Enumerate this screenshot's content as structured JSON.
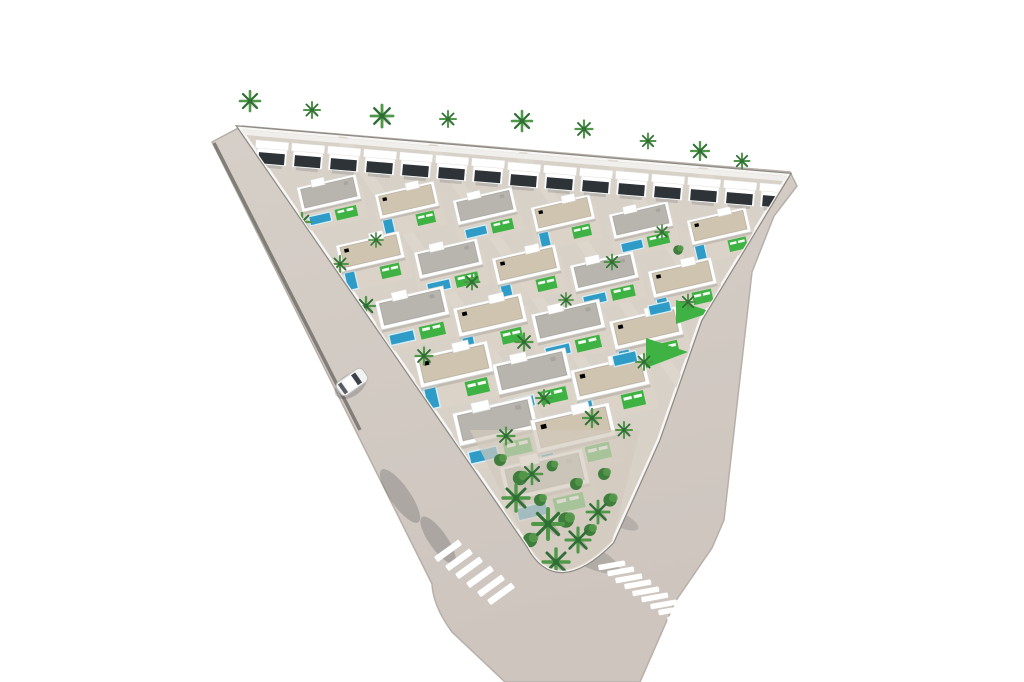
{
  "meta": {
    "title": "Aerial render of a triangular villa development",
    "description": "Bird's-eye 3D architectural rendering of a triangular residential plot filled with white flat-roof villas, each with a small blue swimming pool, bright green lawn and sun loungers. A back row of two-story houses with dark shaded facades lines the top edge. Palm trees are scattered through the plot and cluster at the landscaped bottom tip. Two light grey roads border the plot and meet at a rounded corner at the bottom with two white zebra crosswalks; a single white car drives on the left road. Background is pure white."
  },
  "palette": {
    "bg": "#ffffff",
    "road": "#cdc5be",
    "roadLight": "#d6cfc8",
    "curbDark": "#8e8a84",
    "ground": "#d8d1c8",
    "terrace": "#dcd3c8",
    "wallWhite": "#ffffff",
    "facadeDark": "#2e3338",
    "roofGravel": "#b8b5ae",
    "roofSand": "#cfc4af",
    "pool": "#2f9bc7",
    "lawn": "#3eb343",
    "palmGreen": "#4f9847",
    "palmDark": "#2f6e35",
    "stripe": "#ffffff",
    "street": "#ddd6cd",
    "carBody": "#f2f2f1",
    "carGlass": "#3a4148"
  },
  "scene": {
    "plot_shape": "triangle with rounded bottom corner",
    "white_villa_count": 21,
    "villa_rows": 6,
    "back_row_house_count": 15,
    "pools_color": "#2f9bc7",
    "lawns_color": "#3eb343",
    "palm_tree_count": 31,
    "bush_count": 14,
    "roads": {
      "surface_color": "#cdc5be",
      "left_crosswalk_stripes": 6,
      "right_crosswalk_stripes": 9,
      "vehicle": {
        "type": "car",
        "color": "white",
        "location": "left road"
      }
    }
  }
}
